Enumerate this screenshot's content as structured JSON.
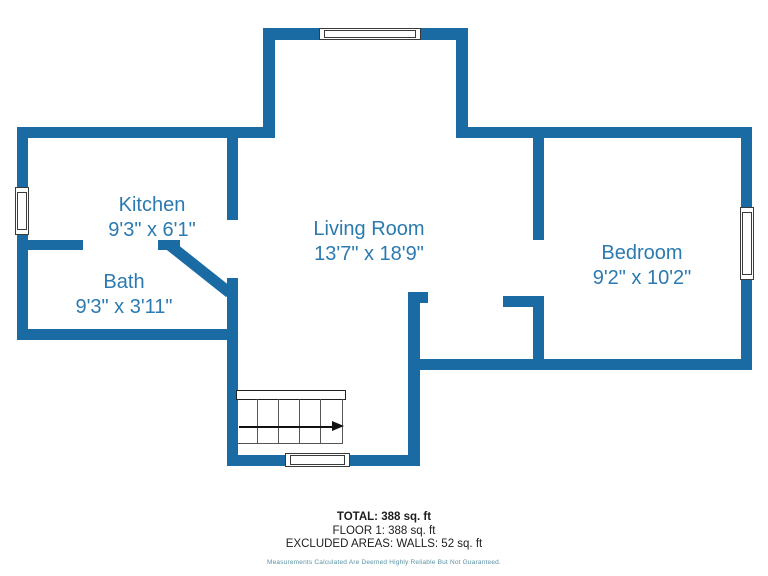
{
  "colors": {
    "wall": "#1a6aa4",
    "room_text": "#2b7ab0",
    "summary_text": "#1d1d1d",
    "disclaimer_text": "#5b93a6"
  },
  "rooms": [
    {
      "name": "Kitchen",
      "dims": "9'3\" x 6'1\""
    },
    {
      "name": "Bath",
      "dims": "9'3\" x 3'11\""
    },
    {
      "name": "Living Room",
      "dims": "13'7\" x 18'9\""
    },
    {
      "name": "Bedroom",
      "dims": "9'2\" x 10'2\""
    }
  ],
  "summary": {
    "lines": [
      "TOTAL: 388 sq. ft",
      "FLOOR 1: 388 sq. ft",
      "EXCLUDED AREAS: WALLS: 52 sq. ft"
    ],
    "disclaimer": "Measurements Calculated Are Deemed Highly Reliable But Not Guaranteed."
  }
}
